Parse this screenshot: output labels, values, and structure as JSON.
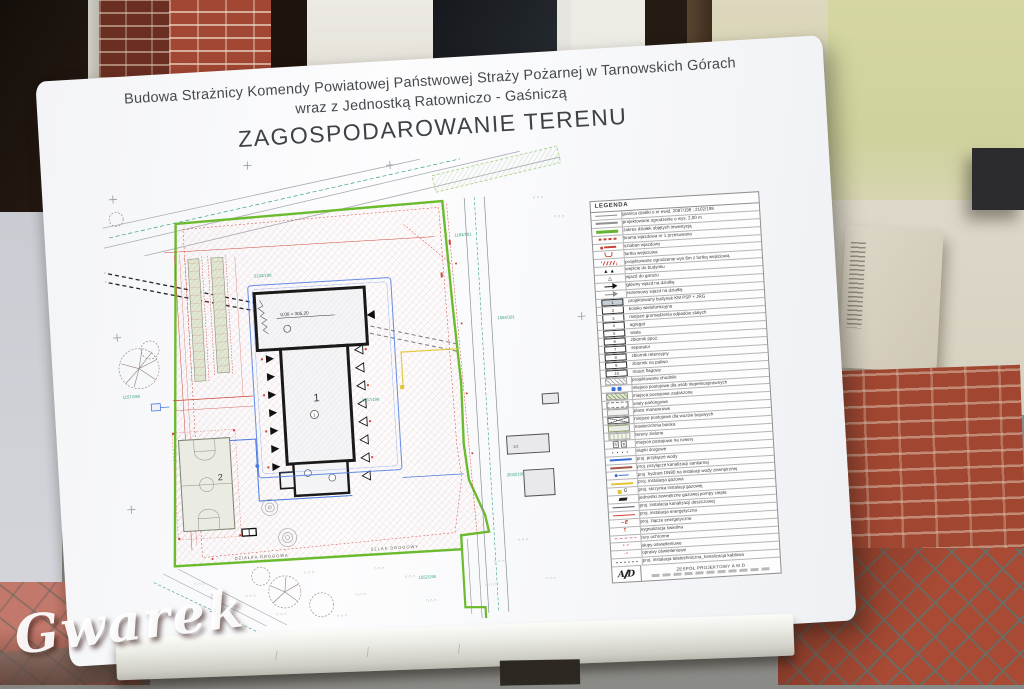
{
  "photo": {
    "watermark": "Gwarek"
  },
  "board": {
    "title_line1": "Budowa Strażnicy Komendy Powiatowej Państwowej Straży Pożarnej w Tarnowskich Górach",
    "title_line2": "wraz z Jednostką Ratowniczo - Gaśniczą",
    "heading": "ZAGOSPODAROWANIE TERENU"
  },
  "plan": {
    "building_label": "1",
    "building_circle": "1",
    "field_label": "2",
    "level_text": "0,00 = 305,20",
    "neighbor_label": "1/2",
    "road_label_a": "DZIAŁKA DROGOWA",
    "road_label_b": "SZLAK DROGOWY",
    "parcels": [
      "1157/198",
      "1554/191",
      "2032/198",
      "1183/191",
      "2087/198",
      "2102/198",
      "1552/198"
    ],
    "colors": {
      "boundary": "#6cbb2f",
      "building": "#191919",
      "water": "#4a7ae0",
      "survey": "#3aa08a",
      "dimension": "#cc4538",
      "gas": "#e3c431"
    }
  },
  "legend": {
    "header": "LEGENDA",
    "rows": [
      {
        "sym": "line-gray",
        "label": "granica działki o nr ewid. 2087/198 ; 2102/198"
      },
      {
        "sym": "line-tick",
        "label": "projektowane ogrodzenie o wys. 2,00 m"
      },
      {
        "sym": "line-green",
        "label": "zakres działek objętych inwestycją"
      },
      {
        "sym": "gate",
        "label": "brama wjazdowa nr 1 przesuwana"
      },
      {
        "sym": "barrier",
        "label": "szlaban wjazdowy"
      },
      {
        "sym": "wicket",
        "label": "furtka wejściowa"
      },
      {
        "sym": "fence6",
        "label": "projektowane ogrodzenie wys 6m z furtką wejściową"
      },
      {
        "sym": "tri-black",
        "label": "wejście do budynku"
      },
      {
        "sym": "tri-open",
        "label": "wjazd do garażu"
      },
      {
        "sym": "arrow-main",
        "label": "główny wjazd na działkę"
      },
      {
        "sym": "arrow-res",
        "label": "rezerwowy wjazd na działkę"
      },
      {
        "sym": "num",
        "num": "1",
        "hl": true,
        "label": "projektowany budynek KM PSP + JRG"
      },
      {
        "sym": "num",
        "num": "2",
        "label": "boisko wielofunkcyjne"
      },
      {
        "sym": "num",
        "num": "3",
        "label": "miejsce gromadzenia odpadów stałych"
      },
      {
        "sym": "num",
        "num": "4",
        "label": "agregat"
      },
      {
        "sym": "num",
        "num": "5",
        "label": "wiata"
      },
      {
        "sym": "num",
        "num": "6",
        "label": "zbiornik ppoż."
      },
      {
        "sym": "num",
        "num": "7",
        "label": "separator"
      },
      {
        "sym": "num",
        "num": "8",
        "label": "zbiornik retencyjny"
      },
      {
        "sym": "num",
        "num": "9",
        "label": "zbiornik na paliwo"
      },
      {
        "sym": "num",
        "num": "10",
        "label": "maszt flagowy"
      },
      {
        "sym": "hatch-gray",
        "label": "projektowane chodniki"
      },
      {
        "sym": "disabled",
        "label": "miejsca postojowe dla osób niepełnosprawnych"
      },
      {
        "sym": "hatch-green",
        "label": "miejsca postojowe zadaszone"
      },
      {
        "sym": "dash-box",
        "label": "wiaty parkingowe"
      },
      {
        "sym": "plain-box",
        "label": "place manewrowe"
      },
      {
        "sym": "cross-box",
        "label": "miejsce postojowe dla wozów bojowych"
      },
      {
        "sym": "court",
        "label": "nawierzchnia boiska"
      },
      {
        "sym": "green-area",
        "label": "tereny zielone"
      },
      {
        "sym": "bike",
        "label": "miejsce postojowe na rowery"
      },
      {
        "sym": "bollards",
        "label": "słupki drogowe"
      },
      {
        "sym": "line-blue",
        "label": "proj. przyłącze wody"
      },
      {
        "sym": "line-brown",
        "label": "proj. przyłącze kanalizacji sanitarnej"
      },
      {
        "sym": "hydrant",
        "label": "proj. hydrant DN80 na instalacji wody zewnętrznej"
      },
      {
        "sym": "line-yellow",
        "label": "proj. instalacja gazowa"
      },
      {
        "sym": "gasbox",
        "label": "proj. skrzynka instalacji gazowej"
      },
      {
        "sym": "heatpump",
        "label": "jednostki zewnętrzne gazowej pompy ciepła"
      },
      {
        "sym": "line-dark",
        "label": "proj. instalacja kanalizacji deszczowej"
      },
      {
        "sym": "line-red",
        "label": "proj. instalacja energetyczna"
      },
      {
        "sym": "e-joint",
        "label": "proj. złącze energetyczne"
      },
      {
        "sym": "signal",
        "label": "sygnalizacja świetlna"
      },
      {
        "sym": "line-pink",
        "label": "rury ochronne"
      },
      {
        "sym": "lightpoles",
        "label": "słupy oświetleniowe"
      },
      {
        "sym": "luminaire",
        "label": "oprawy oświetleniowe"
      },
      {
        "sym": "line-tele",
        "label": "proj. instalacja teletechniczna_kanalizacja kablowa"
      }
    ],
    "footer": {
      "logo_left": "A",
      "logo_right": "D",
      "team": "ZESPÓŁ PROJEKTOWY  A M D"
    }
  }
}
